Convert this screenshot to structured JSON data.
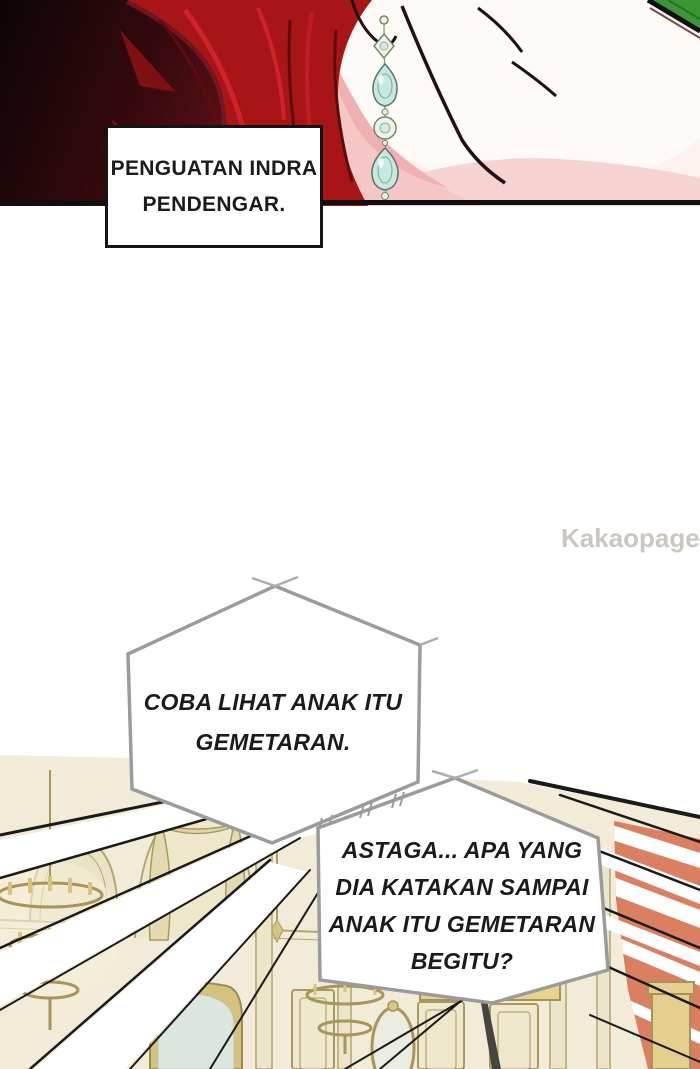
{
  "caption": {
    "lines": [
      "PENGUATAN INDRA",
      "PENDENGAR."
    ]
  },
  "bubble1": {
    "lines": [
      "COBA LIHAT ANAK ITU",
      "GEMETARAN."
    ]
  },
  "bubble2": {
    "lines": [
      "ASTAGA... APA YANG",
      "DIA KATAKAN SAMPAI",
      "ANAK ITU GEMETARAN",
      "BEGITU?"
    ]
  },
  "watermark": {
    "brand": "Kakaopage",
    "suffix": ".co.id"
  },
  "colors": {
    "hair_red": "#a81517",
    "hair_highlight": "#cf2327",
    "panel_dark": "#0d0506",
    "skin_light": "#fdf2f0",
    "skin_pink": "#f4c6c5",
    "earring_aqua": "#c4e8e4",
    "leaf_green": "#3a9733",
    "caption_border": "#141414",
    "bubble_border": "#9b9b9b",
    "palace_cream": "#f1ebd7",
    "palace_gold": "#cbb66e",
    "wall_salmon": "#da7f62",
    "watermark_gray": "#cbc7c0"
  }
}
